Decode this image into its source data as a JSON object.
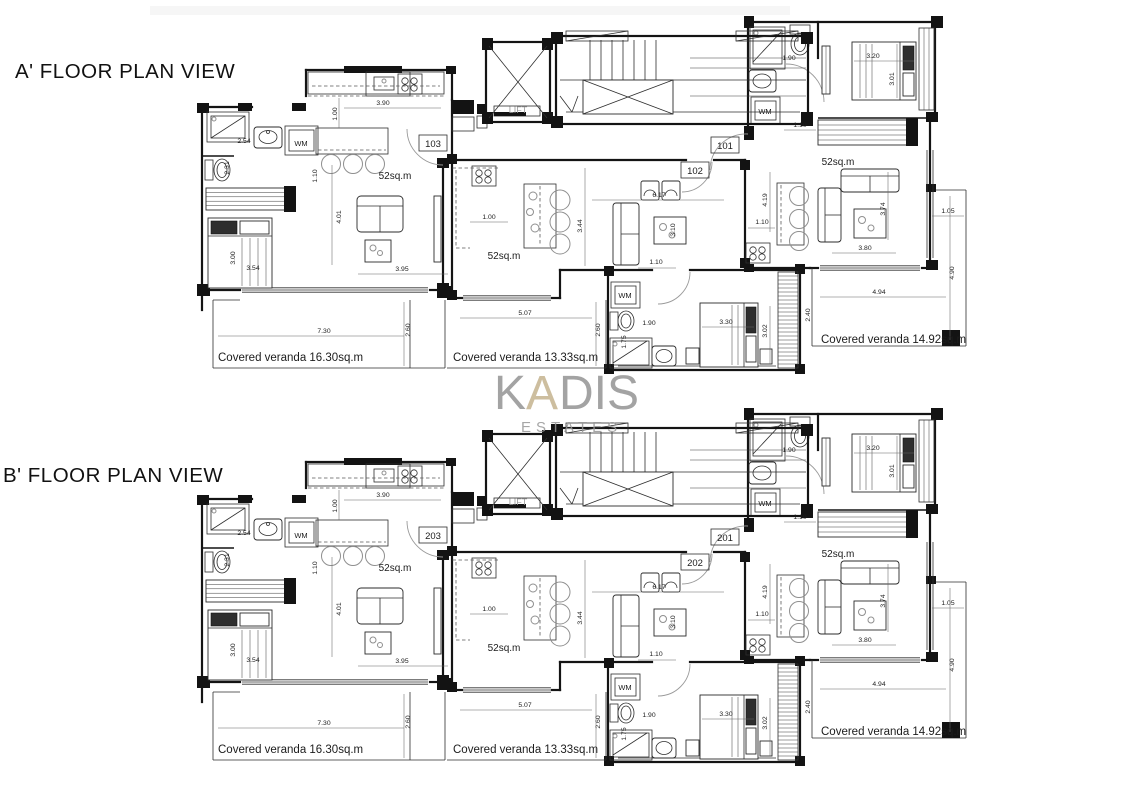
{
  "watermark": {
    "part1": "K",
    "part2": "A",
    "part3": "DIS",
    "subtext": "ESTATES",
    "color": "#8d8d8d",
    "accent_color": "#c8b795"
  },
  "labels": {
    "lift": "LIFT",
    "wm": "WM",
    "area": "52sq.m"
  },
  "verandas": {
    "left": "Covered veranda 16.30sq.m",
    "middle": "Covered veranda 13.33sq.m",
    "right": "Covered veranda 14.92sq.m"
  },
  "plans": [
    {
      "title": "A' FLOOR PLAN VIEW",
      "units": {
        "left": "103",
        "right": "101",
        "middle": "102"
      }
    },
    {
      "title": "B' FLOOR PLAN VIEW",
      "units": {
        "left": "203",
        "right": "201",
        "middle": "202"
      }
    }
  ],
  "dims": {
    "la_bath_w": "2.54",
    "la_bath_d": "2.31",
    "la_hall_w": "1.10",
    "la_bed_l": "3.00",
    "la_bed_w": "3.54",
    "la_kitchen_w": "3.90",
    "la_kitchen_d": "1.00",
    "la_living_h": "4.01",
    "la_living_w": "3.95",
    "la_veranda_w": "7.30",
    "la_veranda_d": "2.60",
    "ma_island": "1.00",
    "ma_living_w": "6.17",
    "ma_living_d": "3.44",
    "ma_table": "3.10",
    "ma_hall": "1.10",
    "ma_bed_w": "3.30",
    "ma_bed_d": "3.02",
    "ma_wc": "1.90",
    "ma_shower": "1.75",
    "ma_veranda_w": "5.07",
    "ma_veranda_d": "2.60",
    "ra_wc": "1.90",
    "ra_bed_w": "3.20",
    "ra_bed_d": "3.01",
    "ra_hall": "1.10",
    "ra_kitchen_h": "4.19",
    "ra_kitchen_w": "1.10",
    "ra_living_h": "3.74",
    "ra_living_w": "3.80",
    "ra_side": "1.05",
    "ra_veranda_h": "4.90",
    "ra_veranda_w": "4.94",
    "ra_veranda_d": "2.40"
  }
}
